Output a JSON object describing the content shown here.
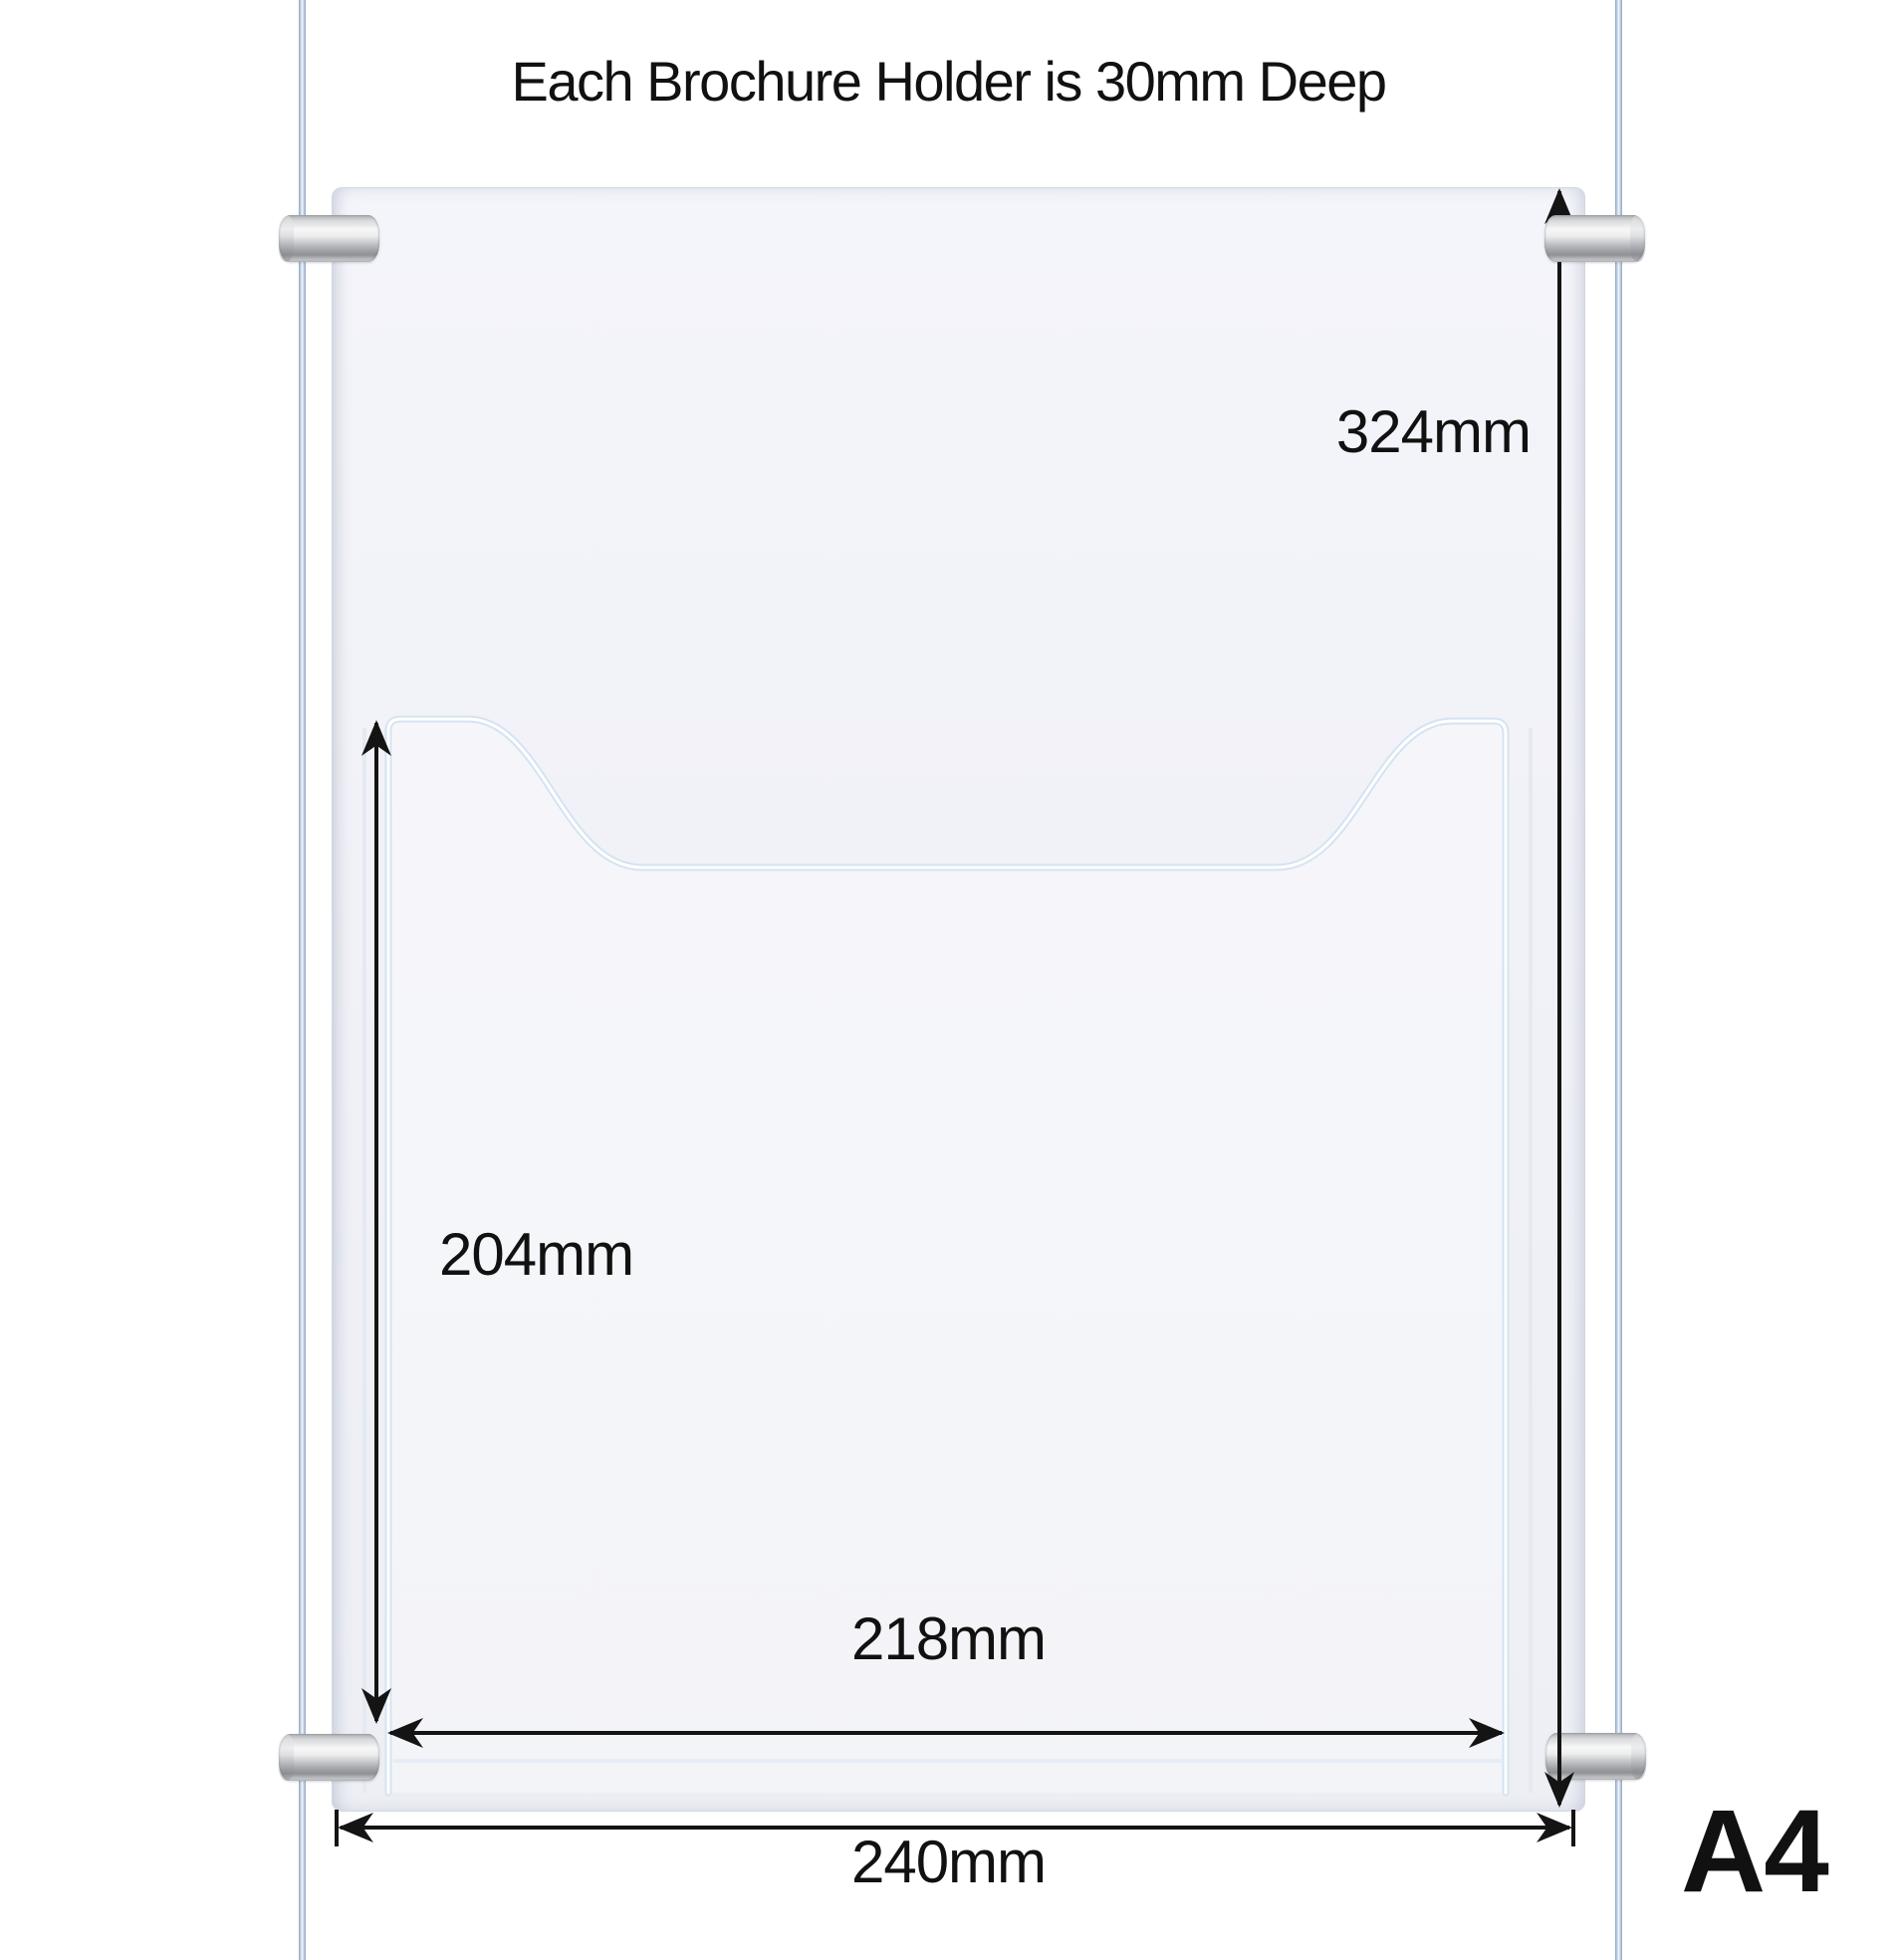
{
  "title": "Each Brochure Holder is 30mm Deep",
  "size_badge": "A4",
  "dimensions": {
    "panel_height": "324mm",
    "pocket_height": "204mm",
    "pocket_width": "218mm",
    "panel_width": "240mm"
  },
  "colors": {
    "arrow": "#141414",
    "cable": "#b9c9de",
    "gripper_silver": "#c6c7ca",
    "panel_fill": "#f1f2f7",
    "pocket_edge_highlight": "#ffffff",
    "pocket_edge_shadow": "#d5e3f2"
  }
}
